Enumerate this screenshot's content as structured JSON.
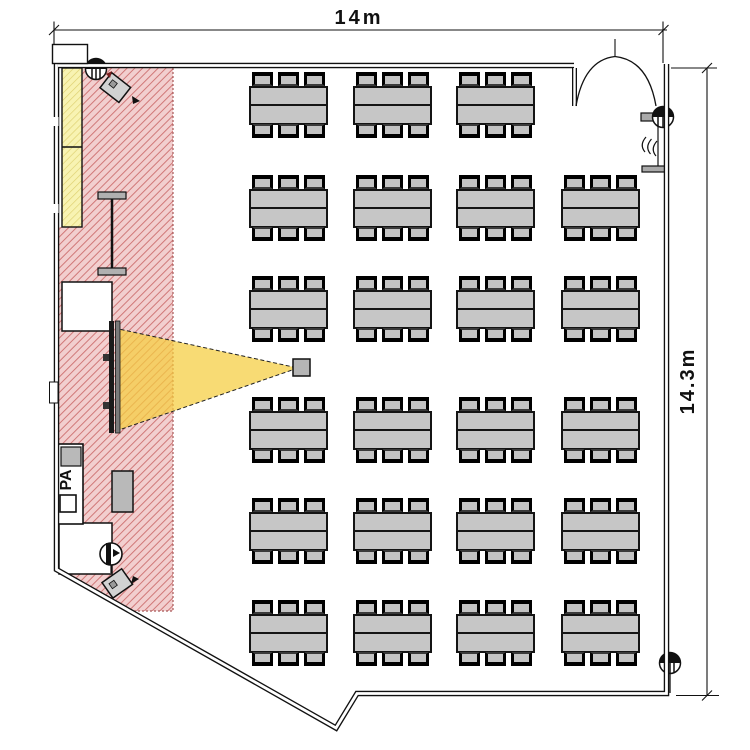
{
  "diagram": {
    "type": "room-floor-plan",
    "dimensions": {
      "width_label": "14m",
      "height_label": "14.3m",
      "width_m": 14,
      "height_m": 14.3
    },
    "labels": {
      "pa_rack": "PA"
    },
    "colors": {
      "stage_hatch_line": "#d07878",
      "stage_hatch_bg": "#f2cfcf",
      "panel_hatch_line": "#ddcf6e",
      "panel_hatch_bg": "#f8f3b2",
      "beam_yellow": "#f5cd3e",
      "furniture_gray": "#c6c6c6",
      "line_black": "#111111"
    },
    "features": [
      "stage-zone-hatched",
      "yellow-wall-panel",
      "projection-screen",
      "projector-beam",
      "projector",
      "microphone-stand",
      "pa-rack",
      "stage-side-table",
      "speaker-box-top",
      "speaker-box-bottom",
      "ceiling-speaker-top-left",
      "wall-speaker-right",
      "ceiling-speaker-bottom-right",
      "speaker-bottom-left",
      "double-door",
      "dimension-lines"
    ],
    "furniture": {
      "table_count": 23,
      "seats_per_table": 6,
      "total_seats": 138,
      "table_unit": {
        "w": 79,
        "body_h": 39,
        "chair_w": 21,
        "chair_h": 14
      },
      "chair_offsets": [
        3,
        29,
        55
      ],
      "rows": [
        {
          "y": 72,
          "xs": [
            249,
            353,
            456
          ]
        },
        {
          "y": 175,
          "xs": [
            249,
            353,
            456,
            561
          ]
        },
        {
          "y": 276,
          "xs": [
            249,
            353,
            456,
            561
          ]
        },
        {
          "y": 397,
          "xs": [
            249,
            353,
            456,
            561
          ]
        },
        {
          "y": 498,
          "xs": [
            249,
            353,
            456,
            561
          ]
        },
        {
          "y": 600,
          "xs": [
            249,
            353,
            456,
            561
          ]
        }
      ]
    }
  }
}
